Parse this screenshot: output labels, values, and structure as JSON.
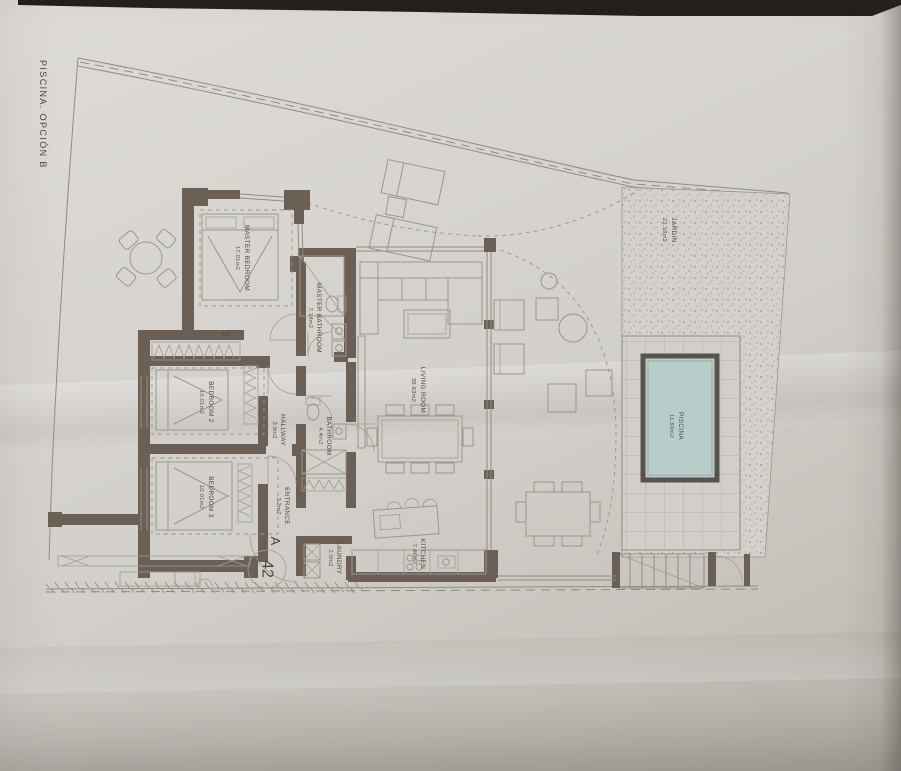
{
  "photo": {
    "side_label": "PISCINA.  OPCIÓN B"
  },
  "rooms": {
    "master_bedroom": {
      "name": "MASTER BEDROOM",
      "area": "17.01m2"
    },
    "master_bathroom": {
      "name": "MASTER BATHROOM",
      "area": "7.14m2"
    },
    "bedroom_2": {
      "name": "BEDROOM 2",
      "area": "10.01m2"
    },
    "bedroom_3": {
      "name": "BEDROOM 3",
      "area": "10.01m2"
    },
    "bathroom": {
      "name": "BATHROOM",
      "area": "4.4m2"
    },
    "hallway": {
      "name": "HALLWAY",
      "area": "3.9m2"
    },
    "living_room": {
      "name": "LIVING ROOM",
      "area": "38.63m2"
    },
    "entrance": {
      "name": "ENTRANCE",
      "area": "3.3m2"
    },
    "laundry": {
      "name": "LAUNDRY",
      "area": "2.9m2"
    },
    "kitchen": {
      "name": "KITCHEN",
      "area": "7.46m2"
    },
    "jardin": {
      "name": "JARDIN",
      "area": "22.18m2"
    },
    "piscina": {
      "name": "PISCINA",
      "area": "11.69m2"
    },
    "ac": {
      "name": "A/C"
    }
  },
  "annotations": {
    "entrance_letter": "A",
    "unit_number": "42"
  },
  "colors": {
    "wall": "#6a6055",
    "line": "#8f8b83",
    "text": "#4c473f",
    "pool_water": "#b6cdca",
    "paper": "#d3d0cb",
    "gravel_dot": "#a9a59e"
  }
}
